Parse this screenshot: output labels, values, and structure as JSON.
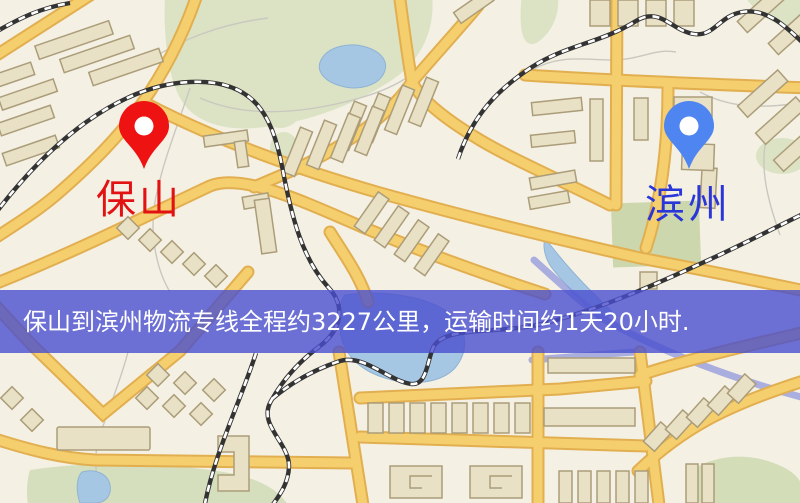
{
  "origin": {
    "label": "保山",
    "pin_icon": "map-pin-icon",
    "pin_color": "#ee1212",
    "label_color": "#e31212"
  },
  "destination": {
    "label": "滨州",
    "pin_icon": "map-pin-icon",
    "pin_color": "#4e85f1",
    "label_color": "#2a36d8"
  },
  "banner": {
    "text": "保山到滨州物流专线全程约3227公里，运输时间约1天20小时.",
    "distance_km": "3227",
    "duration": "1天20小时",
    "bg_fill": "#4a4fce",
    "text_color": "#ffffff"
  },
  "map_colors": {
    "background": "#f5f0e4",
    "road_fill": "#f5cf6d",
    "road_casing": "#e2af50",
    "park_green": "#dbe3c4",
    "water_blue": "#a6c7e3",
    "railway_dark": "#333333",
    "building_fill": "#e9e1c6"
  }
}
